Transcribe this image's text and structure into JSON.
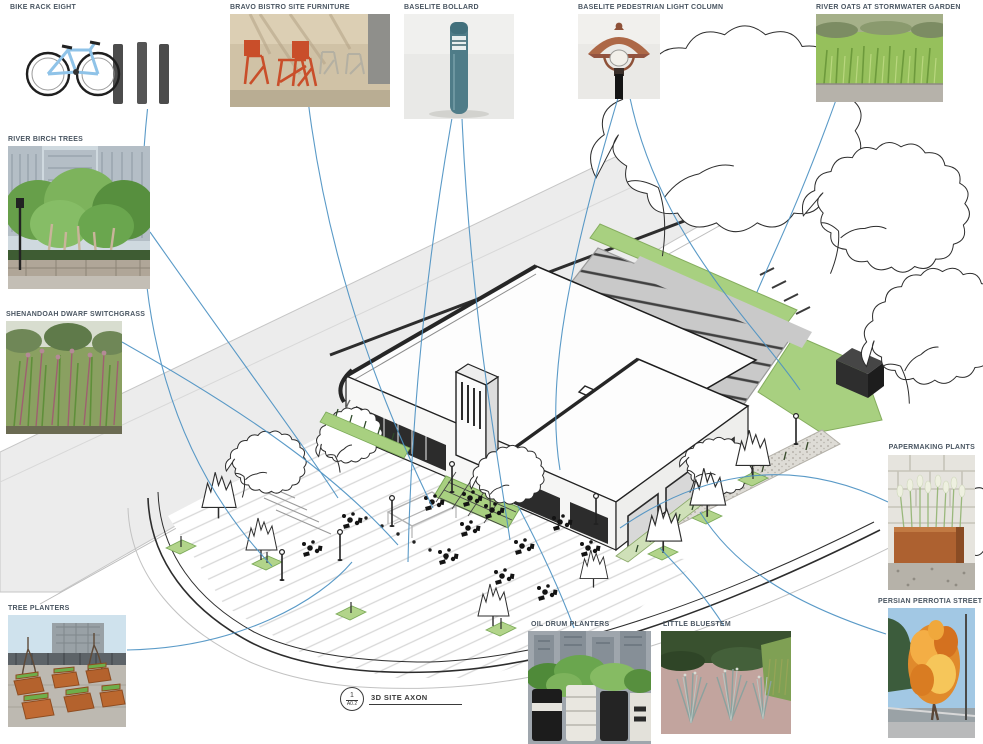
{
  "board": {
    "drawing": {
      "caption": "3D SITE AXON",
      "detail_number": "1",
      "sheet_number": "A0.2"
    },
    "callouts": [
      {
        "id": "bike-rack",
        "label": "BIKE RACK EIGHT"
      },
      {
        "id": "bistro-furniture",
        "label": "BRAVO BISTRO SITE FURNITURE"
      },
      {
        "id": "bollard",
        "label": "BASELITE BOLLARD"
      },
      {
        "id": "light-column",
        "label": "BASELITE PEDESTRIAN LIGHT COLUMN"
      },
      {
        "id": "river-oats",
        "label": "RIVER OATS AT STORMWATER GARDEN"
      },
      {
        "id": "river-birch",
        "label": "RIVER BIRCH TREES"
      },
      {
        "id": "switchgrass",
        "label": "SHENANDOAH DWARF SWITCHGRASS"
      },
      {
        "id": "tree-planters",
        "label": "TREE PLANTERS"
      },
      {
        "id": "oil-drum-planters",
        "label": "OIL DRUM PLANTERS"
      },
      {
        "id": "little-bluestem",
        "label": "LITTLE BLUESTEM"
      },
      {
        "id": "papermaking-plants",
        "label": "PAPERMAKING PLANTS"
      },
      {
        "id": "parrotia-trees",
        "label": "PERSIAN PERROTIA STREET TREES"
      }
    ],
    "colors": {
      "leader_blue": "#4d92c3",
      "street_gray": "#ececec",
      "parking_gray": "#c9c9c9",
      "parking_stripe": "#404040",
      "landscape_green": "#a8d080",
      "line_black": "#222222"
    }
  }
}
